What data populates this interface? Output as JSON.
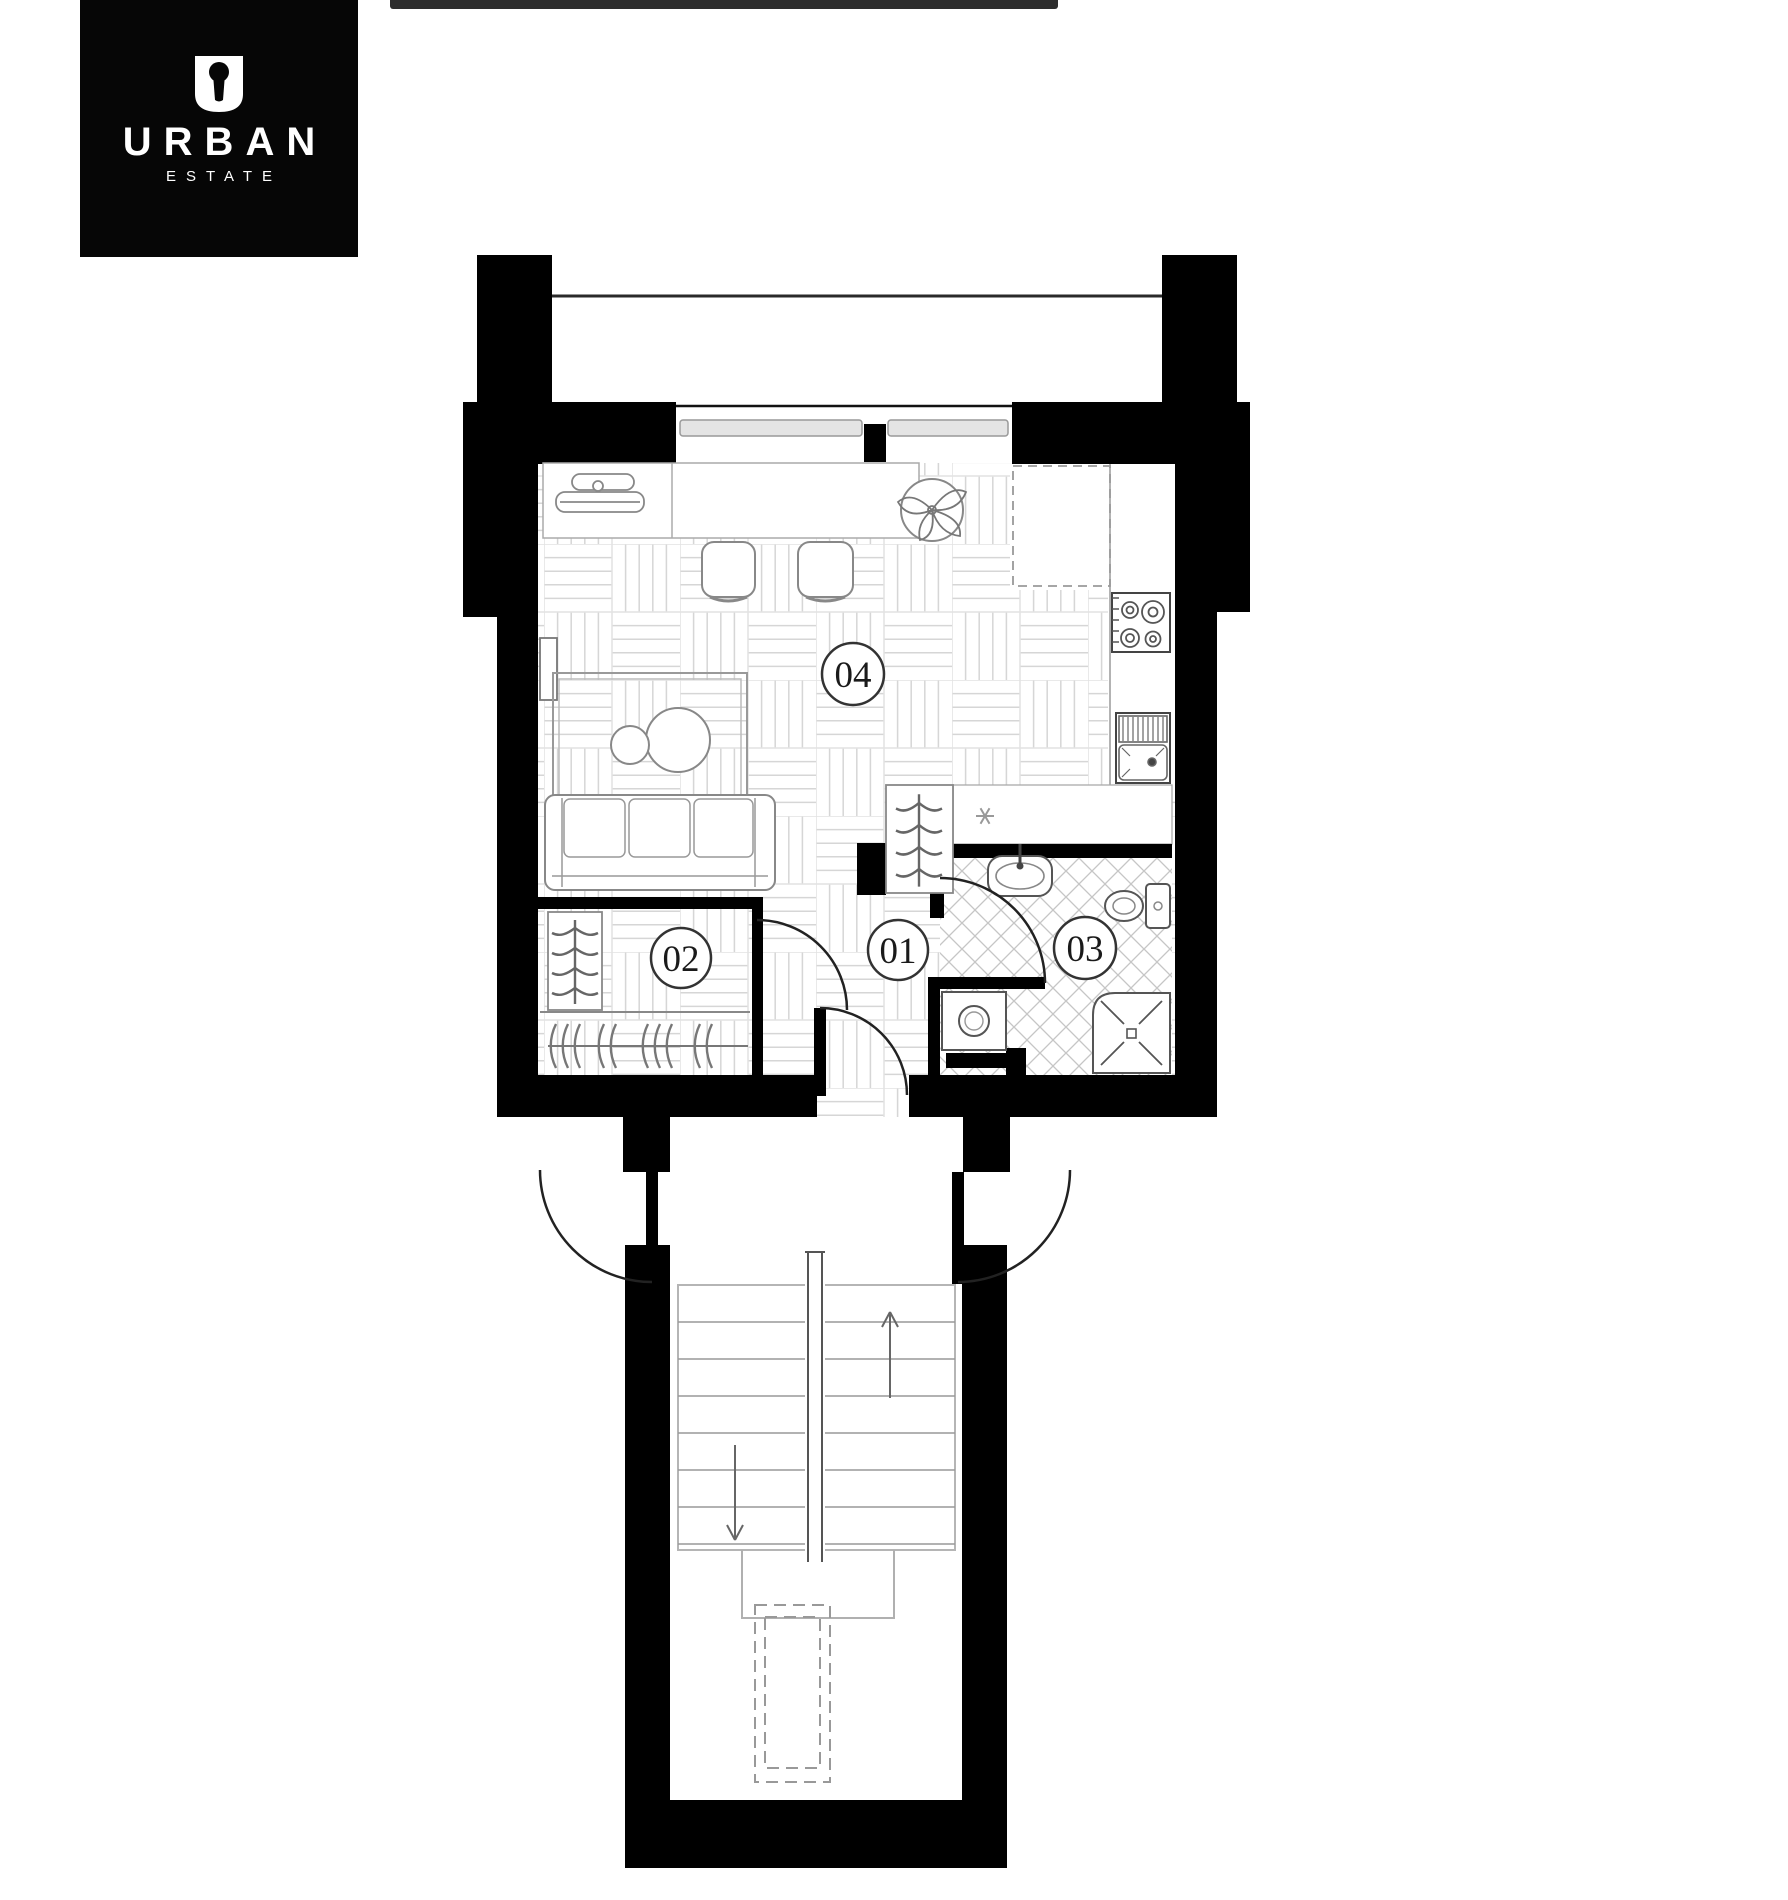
{
  "page": {
    "width": 1788,
    "height": 1900,
    "background": "#ffffff"
  },
  "top_bar": {
    "color": "#2e2e2e"
  },
  "logo": {
    "brand": "URBAN",
    "tagline": "ESTATE",
    "icon": "keyhole-u-icon",
    "background": "#060606",
    "text_color": "#ffffff"
  },
  "plan": {
    "type": "apartment-floor-plan",
    "room_labels": {
      "hall": "01",
      "wardrobe": "02",
      "bathroom": "03",
      "living": "04"
    },
    "colors": {
      "wall": "#000000",
      "door_arc": "#222222",
      "furniture_line": "#888888",
      "parquet_line": "#d6d6d6",
      "tile_line": "#c6c6c6",
      "window_bar_fill": "#e4e4e4"
    },
    "fixtures": [
      "balcony",
      "window-with-mullion",
      "desk-console",
      "dining-table",
      "dining-chairs",
      "potted-plant",
      "tall-cabinet-dashed",
      "stove-4-burner",
      "kitchen-sink-with-drainer",
      "fridge-zone-snowflake",
      "sofa-3-seat",
      "rug-with-coffee-tables",
      "wall-tv",
      "wardrobe-rack",
      "coat-hanger-rail",
      "wash-basin",
      "toilet",
      "shower-cabin",
      "washing-machine",
      "entry-door",
      "double-lobby-doors",
      "stair-flight-up",
      "stair-flight-down",
      "stair-landing",
      "elevator-void-dashed"
    ]
  }
}
